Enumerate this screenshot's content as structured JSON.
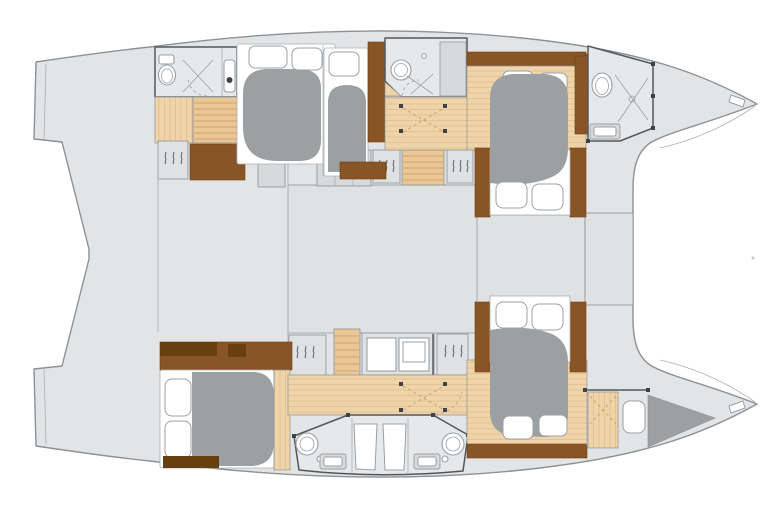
{
  "meta": {
    "type": "floor-plan",
    "subject": "catamaran yacht interior layout, top-down view, bow to the right"
  },
  "colors": {
    "background": "#ffffff",
    "hull_fill": "#e3e4e6",
    "hull_stroke": "#8d9295",
    "room_fill": "#e7e8ea",
    "panel_fill": "#dfe1e3",
    "panel_dark": "#d7d9db",
    "wall_dark": "#53585c",
    "line_light": "#aab0b3",
    "wood_floor": "#efd4a9",
    "wood_line": "#dcbc8e",
    "wood_steps": "#eac795",
    "wood_steps_line": "#c69a63",
    "wood_mid": "#8a5526",
    "wood_dark": "#68400f",
    "bed_gray": "#9ca0a3",
    "white": "#ffffff",
    "fixture_stroke": "#9aa0a4",
    "dot_dark": "#3f4346"
  },
  "inventory": [
    {
      "area": "upper-hull",
      "items": [
        "aft-bathroom",
        "toilet",
        "shower",
        "vanity-sink",
        "aft-companionway-steps",
        "wardrobe",
        "storage-locker",
        "aft-double-bed",
        "single-berth",
        "hull-windows",
        "mid-bathroom",
        "corridor",
        "forward-cabin-island-bed",
        "bow-bathroom",
        "bow-anchor-fitting"
      ]
    },
    {
      "area": "bridgedeck",
      "items": [
        "aft-cockpit-deck",
        "saloon",
        "forward-saloon",
        "drawer-unit",
        "entry-steps-upper",
        "entry-steps-lower",
        "counter-with-sink",
        "wardrobes-with-hangers"
      ]
    },
    {
      "area": "lower-hull",
      "items": [
        "aft-storage-locker",
        "aft-double-bed",
        "corridor",
        "bathroom-left",
        "bathroom-right",
        "shower-stalls",
        "forward-cabin-island-bed",
        "bow-crew-berth",
        "bow-anchor-fitting"
      ]
    },
    {
      "area": "exterior",
      "items": [
        "upper-transom",
        "lower-transom",
        "stern-spine",
        "bow-points",
        "trampoline-gap"
      ]
    }
  ]
}
